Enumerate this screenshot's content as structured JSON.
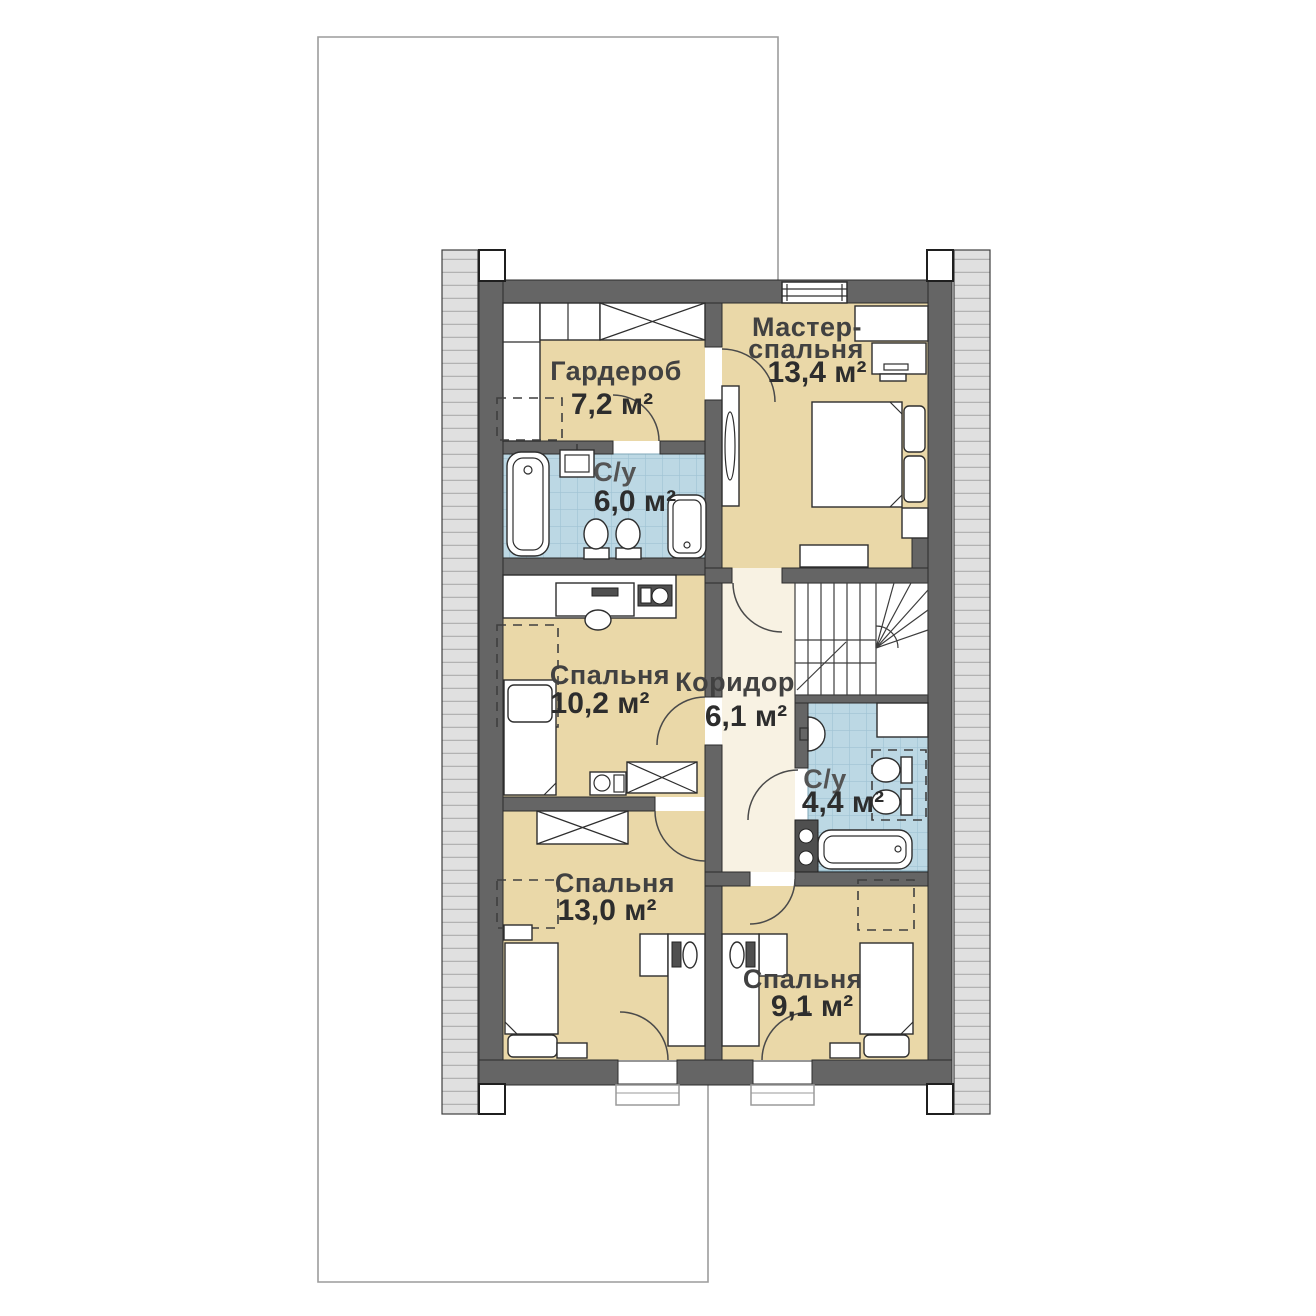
{
  "plan": {
    "floor_type": "second-floor-duplex-plan",
    "colors": {
      "wall": "#656565",
      "room_fill": "#ead8a8",
      "corridor_fill": "#f8f2e3",
      "tile_fill": "#bcd8e4",
      "tile_grid": "#9fc3d3",
      "roof_band": "#e0e0e0",
      "plot_outline": "#9c9c9c"
    },
    "rooms": [
      {
        "id": "master",
        "name_line1": "Мастер-",
        "name_line2": "спальня",
        "area": "13,4 м²"
      },
      {
        "id": "wardrobe",
        "name": "Гардероб",
        "area": "7,2 м²"
      },
      {
        "id": "bath_top",
        "name": "С/у",
        "area": "6,0 м²"
      },
      {
        "id": "bedroom_mid",
        "name": "Спальня",
        "area": "10,2 м²"
      },
      {
        "id": "corridor",
        "name": "Коридор",
        "area": "6,1 м²"
      },
      {
        "id": "bath_mid",
        "name": "С/у",
        "area": "4,4 м²"
      },
      {
        "id": "bedroom_bl",
        "name": "Спальня",
        "area": "13,0 м²"
      },
      {
        "id": "bedroom_br",
        "name": "Спальня",
        "area": "9,1 м²"
      }
    ]
  }
}
